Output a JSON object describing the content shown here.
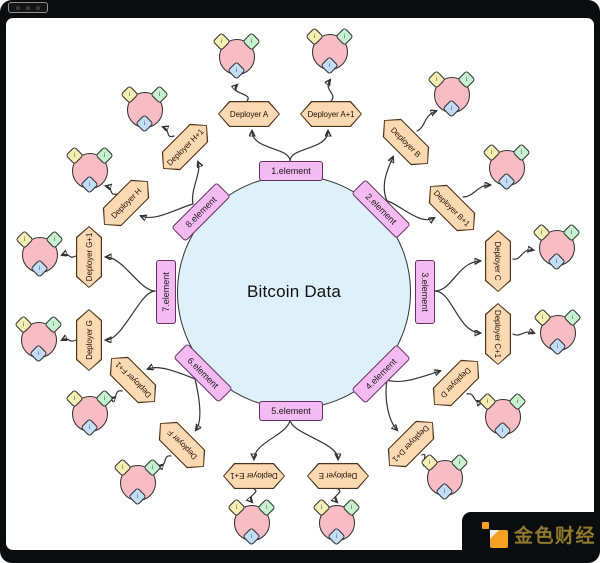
{
  "diagram": {
    "center_label": "Bitcoin Data",
    "elements": [
      "1.element",
      "2.element",
      "3.element",
      "4.element",
      "5.element",
      "6.element",
      "7.element",
      "8.element"
    ],
    "deployers": [
      "Deployer A",
      "Deployer A+1",
      "Deployer B",
      "Deployer B+1",
      "Deployer C",
      "Deployer C+1",
      "Deployer D",
      "Deployer D+1",
      "Deployer E",
      "Deployer E+1",
      "Deployer F",
      "Deployer F+1",
      "Deployer G",
      "Deployer G+1",
      "Deployer H",
      "Deployer H+1"
    ],
    "cluster_badge": "i",
    "colors": {
      "element_fill": "#f4bbf2",
      "element_border": "#633063",
      "deployer_fill": "#fbd9b3",
      "deployer_border": "#4d3319",
      "hub_fill": "#def0f9",
      "cluster_fill": "#f7bcc4",
      "diamond_yellow": "#f5efb4",
      "diamond_green": "#c6f2cf",
      "diamond_blue": "#c3dcf7",
      "line": "#333333"
    }
  },
  "watermark": {
    "text": "金色财经",
    "logo_color": "#f6a021"
  }
}
